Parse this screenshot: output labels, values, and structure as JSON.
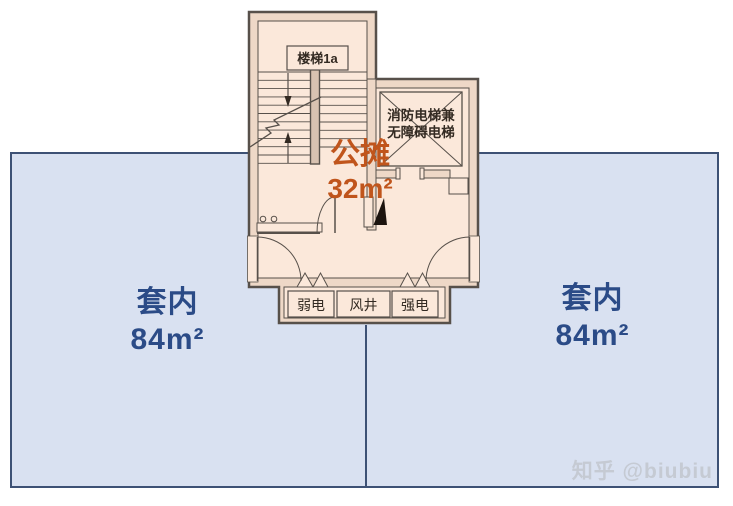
{
  "units": {
    "left": {
      "name": "套内",
      "area": "84m²"
    },
    "right": {
      "name": "套内",
      "area": "84m²"
    }
  },
  "common_area": {
    "name": "公摊",
    "area": "32m²"
  },
  "plan_labels": {
    "stairwell": "楼梯1a",
    "elevator_line1": "消防电梯兼",
    "elevator_line2": "无障碍电梯",
    "weak_power": "弱电",
    "air_shaft": "风井",
    "strong_power": "强电"
  },
  "watermark": "知乎 @biubiu",
  "colors": {
    "unit_fill": "#d9e1f1",
    "unit_border": "#3d5175",
    "unit_text": "#2b4b87",
    "room_fill": "#fbe8da",
    "wall_fill": "#eed8c7",
    "wall_line": "#57504a",
    "accent_orange": "#c0551c",
    "plan_text": "#332a22",
    "watermark_text": "#c5cad3"
  }
}
